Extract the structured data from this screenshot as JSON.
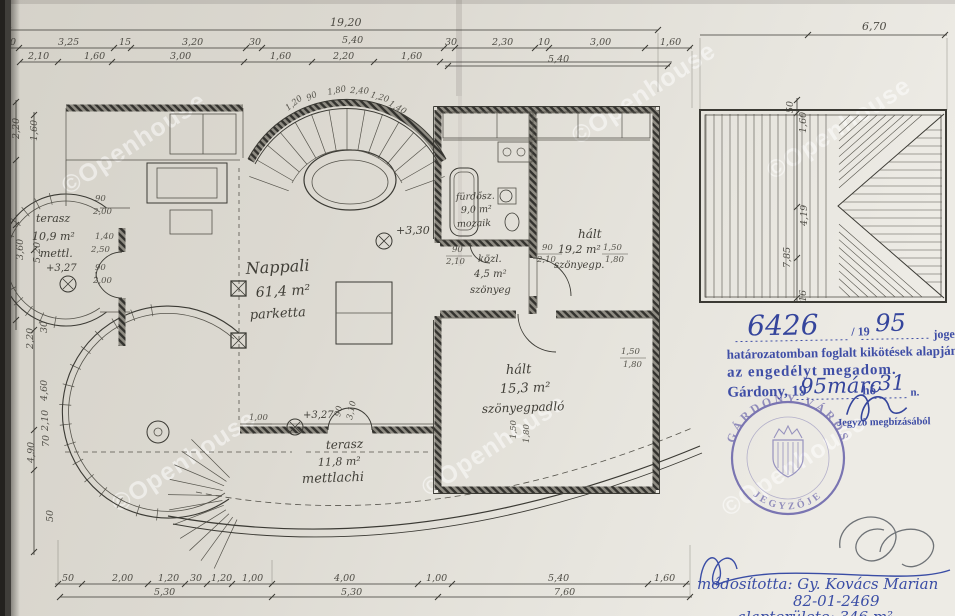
{
  "dims": {
    "top_total_left": "19,20",
    "top_total_right": "6,70",
    "top_row1": [
      "10",
      "3,25",
      "15",
      "3,20",
      "30",
      "5,40",
      "30",
      "2,30",
      "10",
      "3,00",
      "1,60"
    ],
    "top_row2": [
      "2,10",
      "1,60",
      "3,00",
      "1,60",
      "2,20",
      "1,60"
    ],
    "top_row3": [
      "5,40"
    ],
    "bottom_row1": [
      "50",
      "2,00",
      "1,20",
      "30",
      "1,20",
      "1,00",
      "4,00",
      "1,00",
      "5,40",
      "1,60"
    ],
    "bottom_row2": [
      "5,30",
      "5,30",
      "7,60"
    ],
    "left_col": [
      "2,20",
      "1,60",
      "3,60",
      "5,20",
      "2,20",
      "30",
      "4,60",
      "4,90",
      "2,10",
      "70",
      "50"
    ],
    "right_col": [
      "50",
      "1,60",
      "4,19",
      "7,85",
      "16"
    ],
    "bay": [
      "1,20",
      "90",
      "1,80",
      "2,40",
      "1,20",
      "1,40"
    ],
    "small": [
      "90",
      "2,10",
      "90",
      "2,10",
      "1,50",
      "1,80",
      "1,50",
      "1,80",
      "1,50",
      "1,80",
      "1,00",
      "2,40",
      "90",
      "3,10",
      "90",
      "2,00",
      "1,40",
      "2,50",
      "90",
      "2,00"
    ]
  },
  "rooms": {
    "nappali": {
      "l1": "Nappali",
      "l2": "61,4 m²",
      "l3": "parketta"
    },
    "terasz1": {
      "l1": "terasz",
      "l2": "10,9 m²",
      "l3": "mettl."
    },
    "furdo": {
      "l1": "fürdősz.",
      "l2": "9,0 m²",
      "l3": "mozaik"
    },
    "kozl": {
      "l1": "közl.",
      "l2": "4,5 m²",
      "l3": "szönyeg"
    },
    "halo1": {
      "l1": "hált",
      "l2": "19,2 m²",
      "l3": "szönyegp."
    },
    "halo2": {
      "l1": "hált",
      "l2": "15,3 m²",
      "l3": "szönyegpadló"
    },
    "terasz2": {
      "l1": "terasz",
      "l2": "11,8 m²",
      "l3": "mettlachi"
    }
  },
  "levels": {
    "bay": "+3,30",
    "terasz1": "+3,27",
    "terasz2": "+3,27"
  },
  "stamp": {
    "number": "6426",
    "per": "/ 19",
    "year": "95",
    "legal": "jogerős",
    "line2": "határozatomban foglalt kikötések alapján",
    "line3": "az engedélyt megadom.",
    "city": "Gárdony, 19",
    "date": "95márc",
    "ho": "hó",
    "day": "31",
    "n": "n.",
    "delegate": "Jegyző megbízásából"
  },
  "seal": {
    "top": "GÁRDONY VÁROS",
    "bottom": "JEGYZŐJE"
  },
  "footer": {
    "modified": "módosította: Gy. Kovács Marian",
    "code": "82-01-2469",
    "cut": "alapterülete: 346 m²"
  },
  "watermark": {
    "symbol": "©",
    "text": "Openhouse"
  }
}
